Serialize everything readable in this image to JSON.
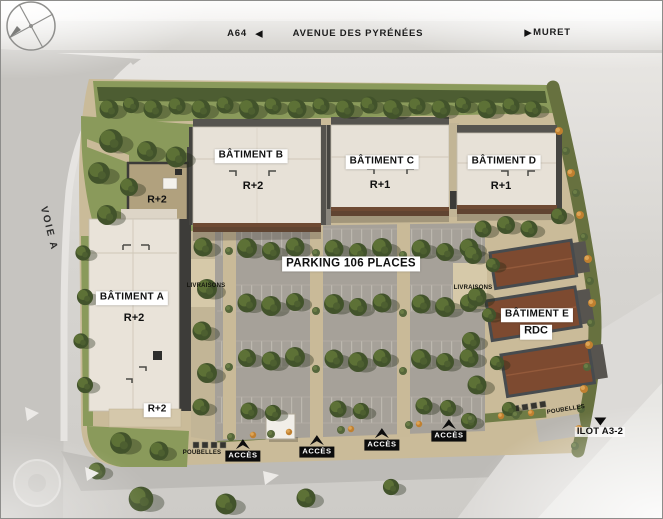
{
  "scene": {
    "top_road": {
      "highway": "A64",
      "street": "AVENUE DES PYRÉNÉES",
      "destination": "MURET"
    },
    "side_road": "VOIE A",
    "parking": "PARKING 106 PLACES",
    "buildings": {
      "a": {
        "name": "BÂTIMENT A",
        "floors": "R+2",
        "floors_south": "R+2"
      },
      "annex": {
        "floors": "R+2"
      },
      "b": {
        "name": "BÂTIMENT B",
        "floors": "R+2"
      },
      "c": {
        "name": "BÂTIMENT C",
        "floors": "R+1"
      },
      "d": {
        "name": "BÂTIMENT D",
        "floors": "R+1"
      },
      "e": {
        "name": "BÂTIMENT E",
        "floors": "RDC"
      }
    },
    "annotations": {
      "livraisons_west": "LIVRAISONS",
      "livraisons_east": "LIVRAISONS",
      "acces": "ACCÈS",
      "poubelles_southwest": "POUBELLES",
      "poubelles_east": "POUBELLES",
      "ilot": "ILOT A3-2"
    },
    "colors": {
      "lawn": "#8a9a5b",
      "hedge": "#4d5d32",
      "sand": "#cabb99",
      "asphalt": "#a6a199",
      "roof_light": "#e7e1d7",
      "roof_brown": "#7d4a30",
      "road": "#c9c7c3",
      "label_bg": "#ffffff",
      "label_fg": "#101010",
      "shrub_orange": "#c08030"
    }
  }
}
